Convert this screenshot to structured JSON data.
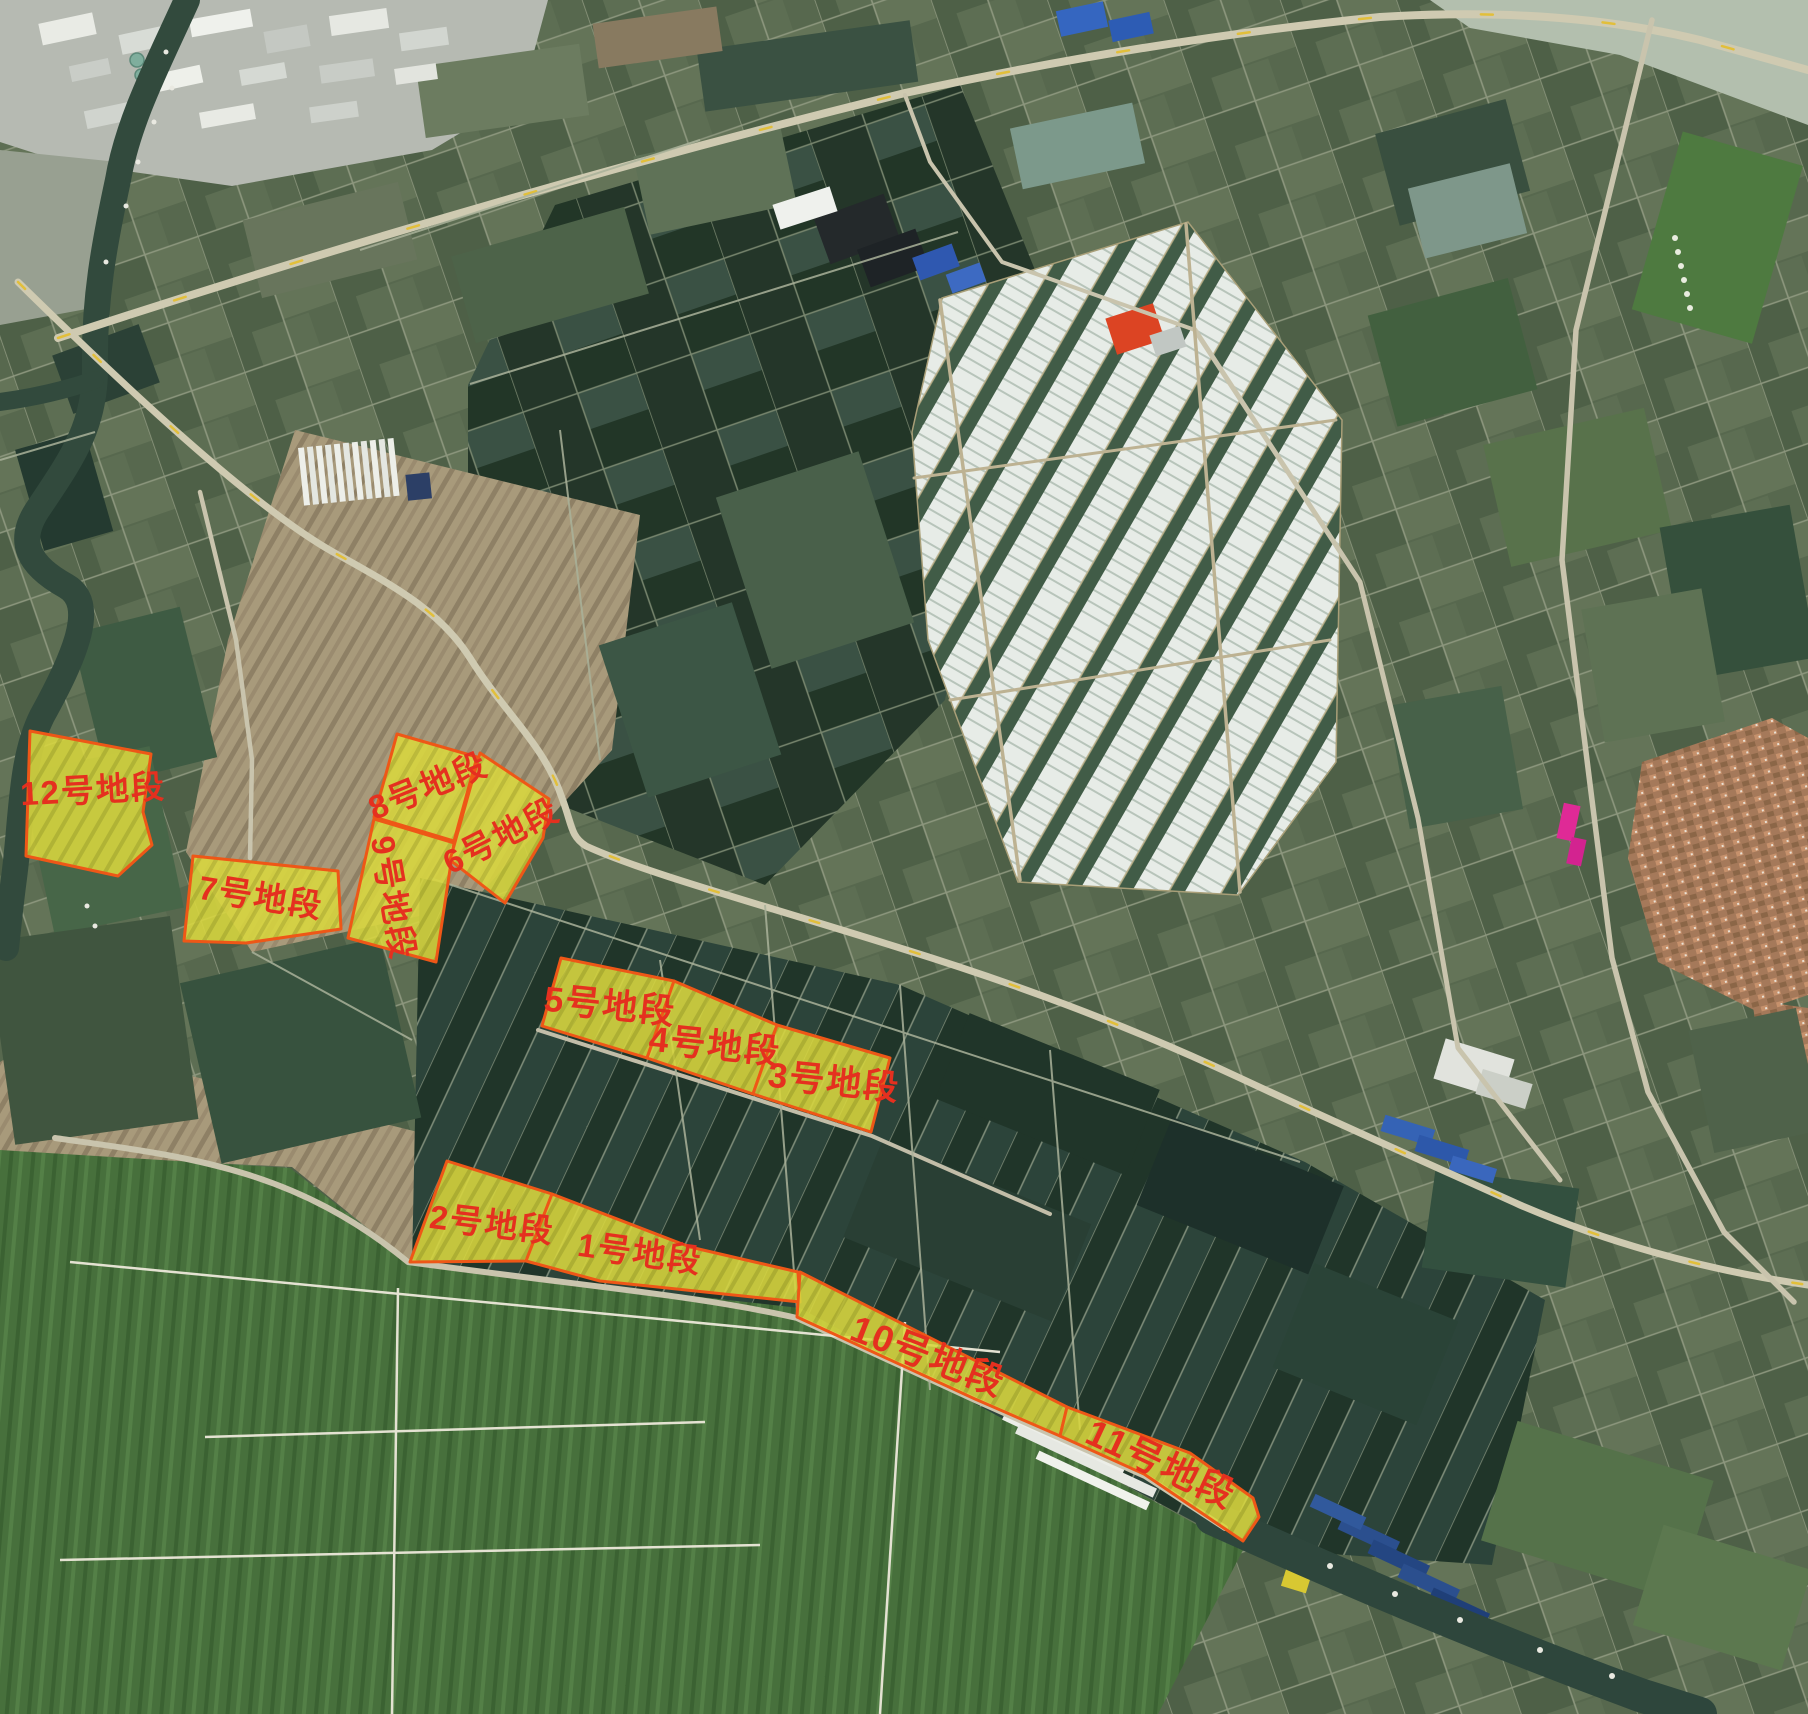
{
  "map": {
    "kind": "satellite-imagery-with-land-parcel-annotations",
    "colors": {
      "parcel_fill": "#d9d73e",
      "parcel_border": "#ee5717",
      "label_color": "#e5301f"
    },
    "parcels": [
      {
        "id": "12",
        "points": [
          [
            30,
            731
          ],
          [
            151,
            754
          ],
          [
            143,
            812
          ],
          [
            152,
            845
          ],
          [
            118,
            876
          ],
          [
            26,
            856
          ]
        ],
        "label": {
          "text": "12号地段",
          "x": 93,
          "y": 790,
          "rotate": -3,
          "size": 33
        }
      },
      {
        "id": "7",
        "points": [
          [
            193,
            856
          ],
          [
            338,
            871
          ],
          [
            341,
            929
          ],
          [
            246,
            943
          ],
          [
            184,
            941
          ]
        ],
        "label": {
          "text": "7号地段",
          "x": 261,
          "y": 897,
          "rotate": 9,
          "size": 33
        }
      },
      {
        "id": "8",
        "points": [
          [
            397,
            734
          ],
          [
            477,
            757
          ],
          [
            454,
            841
          ],
          [
            374,
            817
          ]
        ],
        "label": {
          "text": "8号地段",
          "x": 428,
          "y": 786,
          "rotate": -22,
          "size": 33
        }
      },
      {
        "id": "9",
        "points": [
          [
            374,
            819
          ],
          [
            454,
            843
          ],
          [
            436,
            962
          ],
          [
            348,
            938
          ]
        ],
        "label": {
          "text": "9号地段",
          "x": 393,
          "y": 898,
          "rotate": 80,
          "size": 33
        }
      },
      {
        "id": "6",
        "points": [
          [
            480,
            753
          ],
          [
            549,
            799
          ],
          [
            543,
            838
          ],
          [
            505,
            903
          ],
          [
            450,
            860
          ]
        ],
        "label": {
          "text": "6号地段",
          "x": 501,
          "y": 836,
          "rotate": -27,
          "size": 33
        }
      },
      {
        "id": "5",
        "points": [
          [
            561,
            958
          ],
          [
            674,
            981
          ],
          [
            647,
            1058
          ],
          [
            542,
            1026
          ]
        ],
        "label": {
          "text": "5号地段",
          "x": 610,
          "y": 1006,
          "rotate": 6,
          "size": 35
        }
      },
      {
        "id": "4",
        "points": [
          [
            674,
            981
          ],
          [
            777,
            1025
          ],
          [
            753,
            1094
          ],
          [
            647,
            1058
          ]
        ],
        "label": {
          "text": "4号地段",
          "x": 715,
          "y": 1046,
          "rotate": 6,
          "size": 35
        }
      },
      {
        "id": "3",
        "points": [
          [
            777,
            1025
          ],
          [
            890,
            1058
          ],
          [
            871,
            1132
          ],
          [
            753,
            1094
          ]
        ],
        "label": {
          "text": "3号地段",
          "x": 834,
          "y": 1082,
          "rotate": 6,
          "size": 35
        }
      },
      {
        "id": "2",
        "points": [
          [
            447,
            1161
          ],
          [
            552,
            1194
          ],
          [
            526,
            1261
          ],
          [
            410,
            1262
          ]
        ],
        "label": {
          "text": "2号地段",
          "x": 492,
          "y": 1224,
          "rotate": 7,
          "size": 33
        }
      },
      {
        "id": "1",
        "points": [
          [
            552,
            1194
          ],
          [
            690,
            1247
          ],
          [
            798,
            1272
          ],
          [
            800,
            1302
          ],
          [
            600,
            1281
          ],
          [
            526,
            1261
          ]
        ],
        "label": {
          "text": "1号地段",
          "x": 640,
          "y": 1253,
          "rotate": 8,
          "size": 33
        }
      },
      {
        "id": "10",
        "points": [
          [
            800,
            1272
          ],
          [
            1067,
            1407
          ],
          [
            1060,
            1436
          ],
          [
            975,
            1399
          ],
          [
            797,
            1317
          ]
        ],
        "label": {
          "text": "10号地段",
          "x": 928,
          "y": 1356,
          "rotate": 21,
          "size": 37
        }
      },
      {
        "id": "11",
        "points": [
          [
            1067,
            1407
          ],
          [
            1190,
            1453
          ],
          [
            1253,
            1498
          ],
          [
            1259,
            1517
          ],
          [
            1243,
            1541
          ],
          [
            1144,
            1474
          ],
          [
            1060,
            1436
          ]
        ],
        "label": {
          "text": "11号地段",
          "x": 1161,
          "y": 1464,
          "rotate": 25,
          "size": 37
        }
      }
    ]
  }
}
